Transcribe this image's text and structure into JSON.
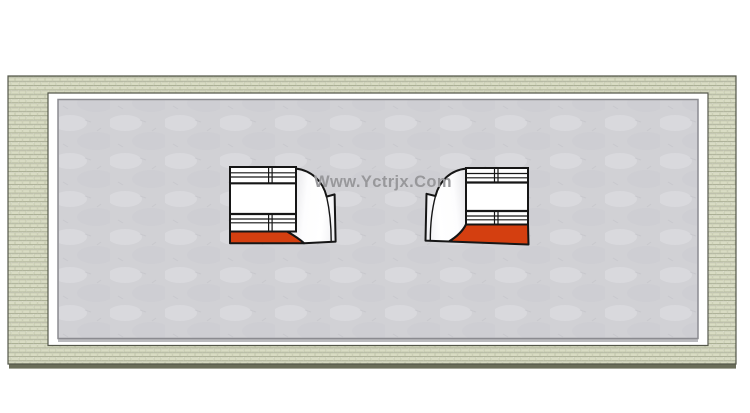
{
  "watermark": {
    "text": "Www.Yctrjx.Com",
    "color": "#98989b"
  },
  "colors": {
    "background": "#ffffff",
    "floor": "#d1d1d5",
    "floor_border": "#8b8b90",
    "floor_shadow": "#a9a9ae",
    "brick_face": "#d9dcc4",
    "brick_mortar": "#f1f2e6",
    "brick_joint": "#8f947a",
    "wall_outline": "#54574a",
    "wall_edge": "#6a6d59",
    "ramp_surface": "#ffffff",
    "ramp_side_face": "#f5f5f7",
    "ramp_outline": "#161616",
    "ramp_base": "#d43f10"
  },
  "scene": {
    "objects": [
      {
        "id": "perimeter-wall",
        "name": "brick perimeter wall"
      },
      {
        "id": "concrete-floor",
        "name": "concrete floor slab"
      },
      {
        "id": "quarter-pipe-left",
        "name": "quarter pipe ramp facing right"
      },
      {
        "id": "quarter-pipe-right",
        "name": "quarter pipe ramp facing left"
      }
    ]
  }
}
